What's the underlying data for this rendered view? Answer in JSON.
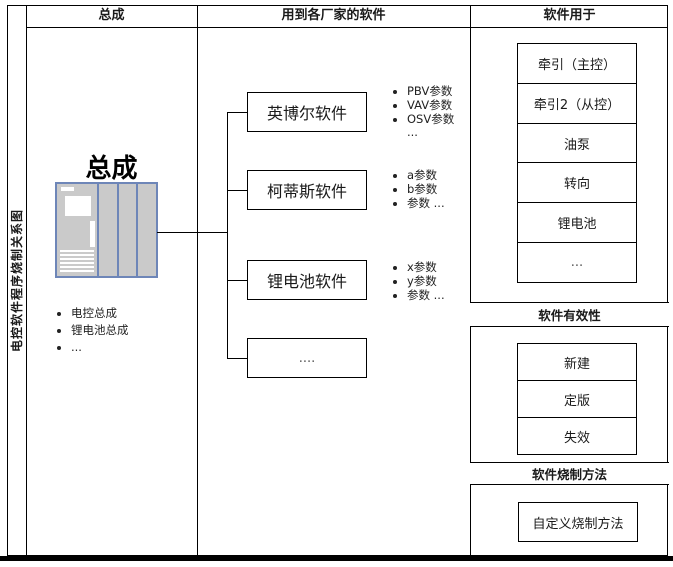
{
  "side_label": "电控软件程序烧制关系图",
  "headers": {
    "assembly": "总成",
    "vendors": "用到各厂家的软件",
    "usage": "软件用于"
  },
  "assembly": {
    "title": "总成",
    "bullets": [
      "电控总成",
      "锂电池总成",
      "..."
    ]
  },
  "vendors": [
    {
      "label": "英博尔软件",
      "params": [
        "PBV参数",
        "VAV参数",
        "OSV参数"
      ],
      "more": "..."
    },
    {
      "label": "柯蒂斯软件",
      "params": [
        "a参数",
        "b参数",
        "参数 ..."
      ]
    },
    {
      "label": "锂电池软件",
      "params": [
        "x参数",
        "y参数",
        "参数 ..."
      ]
    },
    {
      "label": "...."
    }
  ],
  "usage_targets": [
    "牵引（主控）",
    "牵引2（从控）",
    "油泵",
    "转向",
    "锂电池",
    "..."
  ],
  "validity": {
    "header": "软件有效性",
    "items": [
      "新建",
      "定版",
      "失效"
    ]
  },
  "burn": {
    "header": "软件烧制方法",
    "item": "自定义烧制方法"
  },
  "colors": {
    "line": "#000000",
    "cabinet_border": "#6e86b8",
    "cabinet_fill": "#cacaca"
  }
}
